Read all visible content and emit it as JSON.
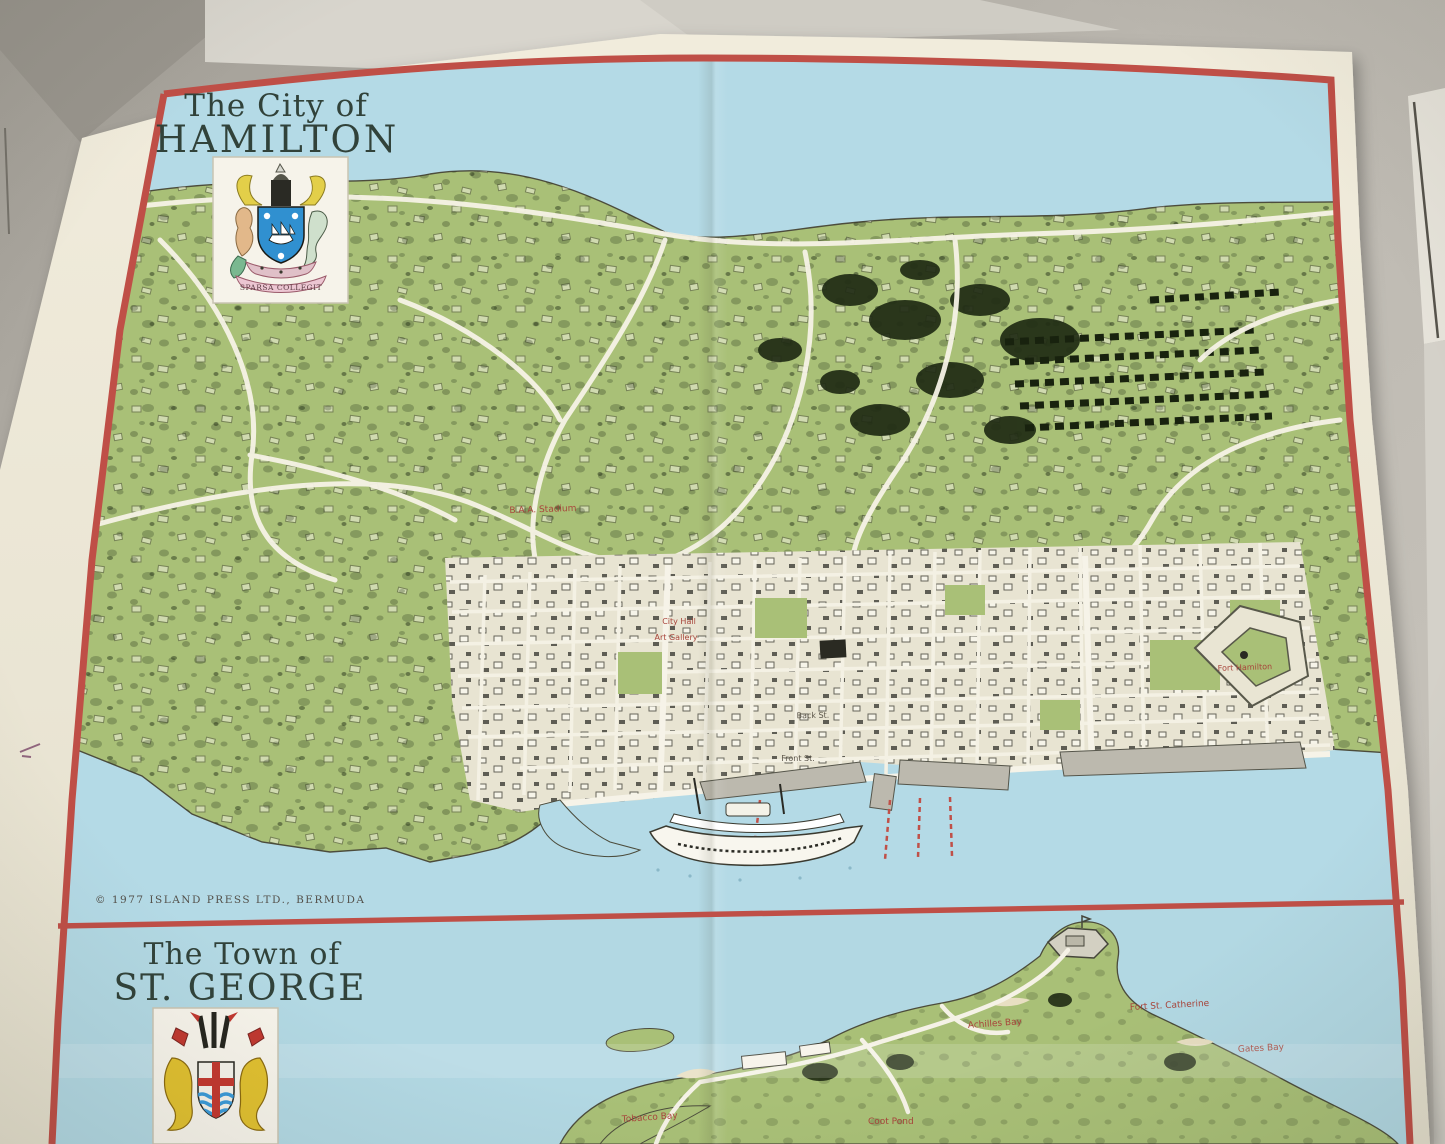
{
  "hamilton": {
    "title_top": "The City of",
    "title_main": "HAMILTON",
    "crest_motto": "SPARSA COLLEGIT",
    "copyright": "© 1977 ISLAND PRESS LTD., BERMUDA",
    "labels": {
      "stadium": "B.A.A. Stadium",
      "city_hall": "City Hall",
      "art_gallery": "Art Gallery",
      "back_st": "Back St.",
      "front_st": "Front St.",
      "fort_hamilton": "Fort Hamilton"
    }
  },
  "st_george": {
    "title_top": "The Town of",
    "title_main": "ST. GEORGE",
    "labels": {
      "fort_st_catherine": "Fort St. Catherine",
      "achilles_bay": "Achilles Bay",
      "gates_bay": "Gates Bay",
      "coot_pond": "Coot Pond",
      "tobacco_bay": "Tobacco Bay"
    }
  },
  "colors": {
    "water": "#b4dae6",
    "land": "#a9c077",
    "border_red": "#bf4f47",
    "paper": "#ece7d6",
    "label_red": "#a8453b"
  }
}
